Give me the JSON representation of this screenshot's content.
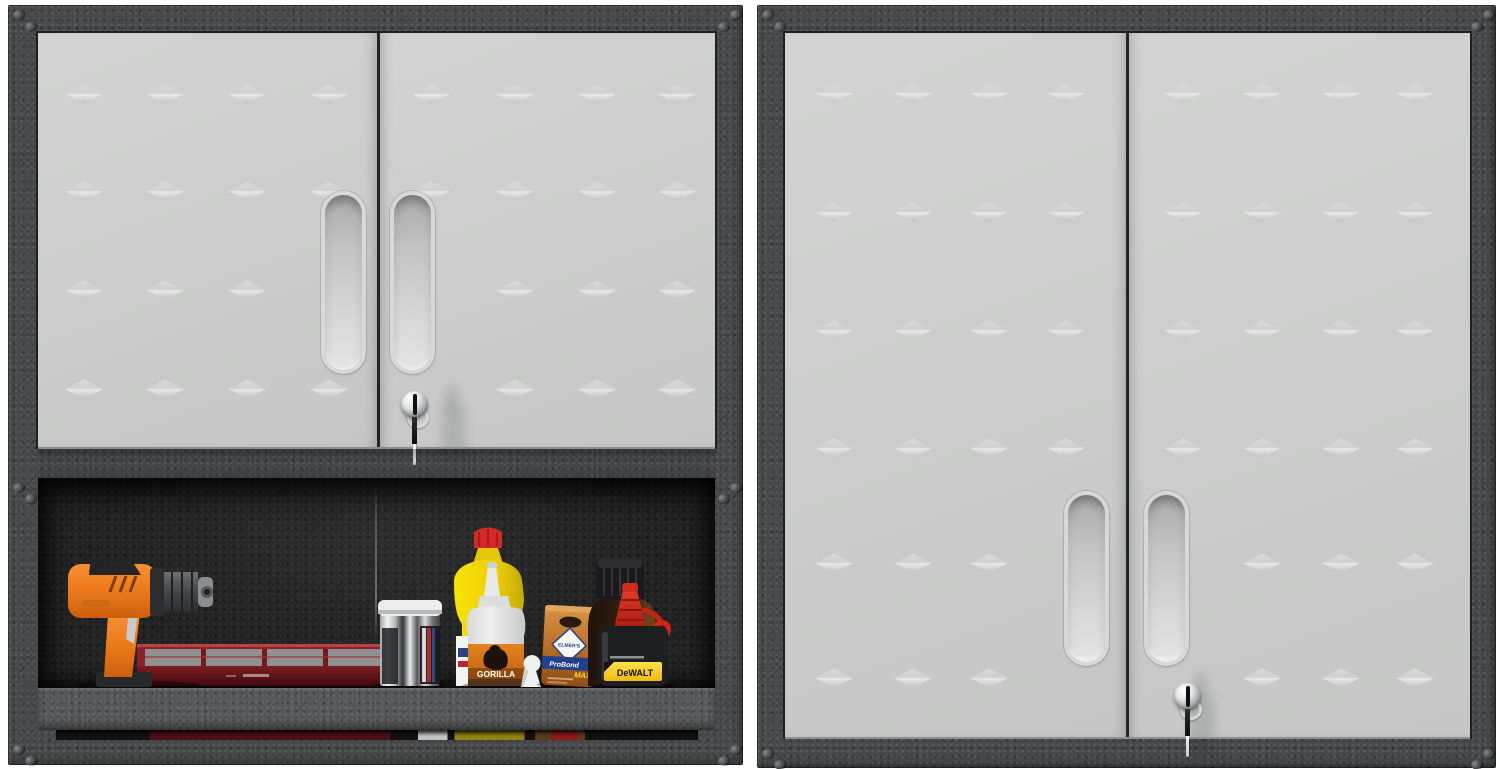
{
  "scene": {
    "type": "product-photo",
    "description": "Two-view product photo of a gray steel garage wall cabinet with diamond-embossed doors; left view shows the lower open shelf compartment stocked with tools, right view shows the taller cabinet fully closed with key in the lock.",
    "background": "#ffffff"
  },
  "colors": {
    "frame": "#47494b",
    "door": "#cbcccb",
    "interior": "#222222",
    "shelf_lip": "#57585a",
    "drill_orange": "#ee7c1d",
    "tray_red": "#8e2126",
    "glue_yellow": "#f2d804",
    "gorilla_orange": "#d9731a",
    "elmers_copper": "#bd7427",
    "probond_blue": "#23408f",
    "dewalt_yellow": "#f6c60e",
    "dewalt_red": "#d22a1f"
  },
  "left_cabinet": {
    "name": "wall cabinet with open lower shelf",
    "studs": {
      "door1": {
        "rows": [
          61,
          158,
          257,
          356
        ],
        "cols": [
          46,
          127,
          209,
          291
        ],
        "skip": [
          "2,3"
        ]
      },
      "door2": {
        "rows": [
          61,
          158,
          257,
          356
        ],
        "cols": [
          393,
          477,
          559,
          639
        ],
        "skip": [
          "2,0",
          "3,0"
        ]
      }
    },
    "lock": {
      "key_inserted": true
    }
  },
  "right_cabinet": {
    "name": "tall wall cabinet, doors closed",
    "studs": {
      "door1": {
        "rows": [
          60,
          179,
          297,
          415,
          530,
          645
        ],
        "cols": [
          49,
          128,
          204,
          281
        ],
        "skip": [
          "4,3",
          "5,3"
        ]
      },
      "door2": {
        "rows": [
          60,
          179,
          297,
          415,
          530,
          645
        ],
        "cols": [
          398,
          477,
          556,
          630
        ],
        "skip": [
          "4,0",
          "5,0"
        ]
      }
    },
    "lock": {
      "key_inserted": true
    }
  },
  "shelf_items": {
    "list": [
      "cordless drill",
      "parts organizer tray",
      "metal can",
      "yellow glue bottle",
      "Gorilla glue bottle",
      "keyhole hanger",
      "Elmer's ProBond Max",
      "brown jug",
      "DeWalt chalk bottle"
    ],
    "labels": {
      "gorilla": "GORILLA",
      "elmers": "ELMER'S",
      "probond": "ProBond",
      "max": "MAX",
      "dewalt": "DeWALT"
    }
  }
}
